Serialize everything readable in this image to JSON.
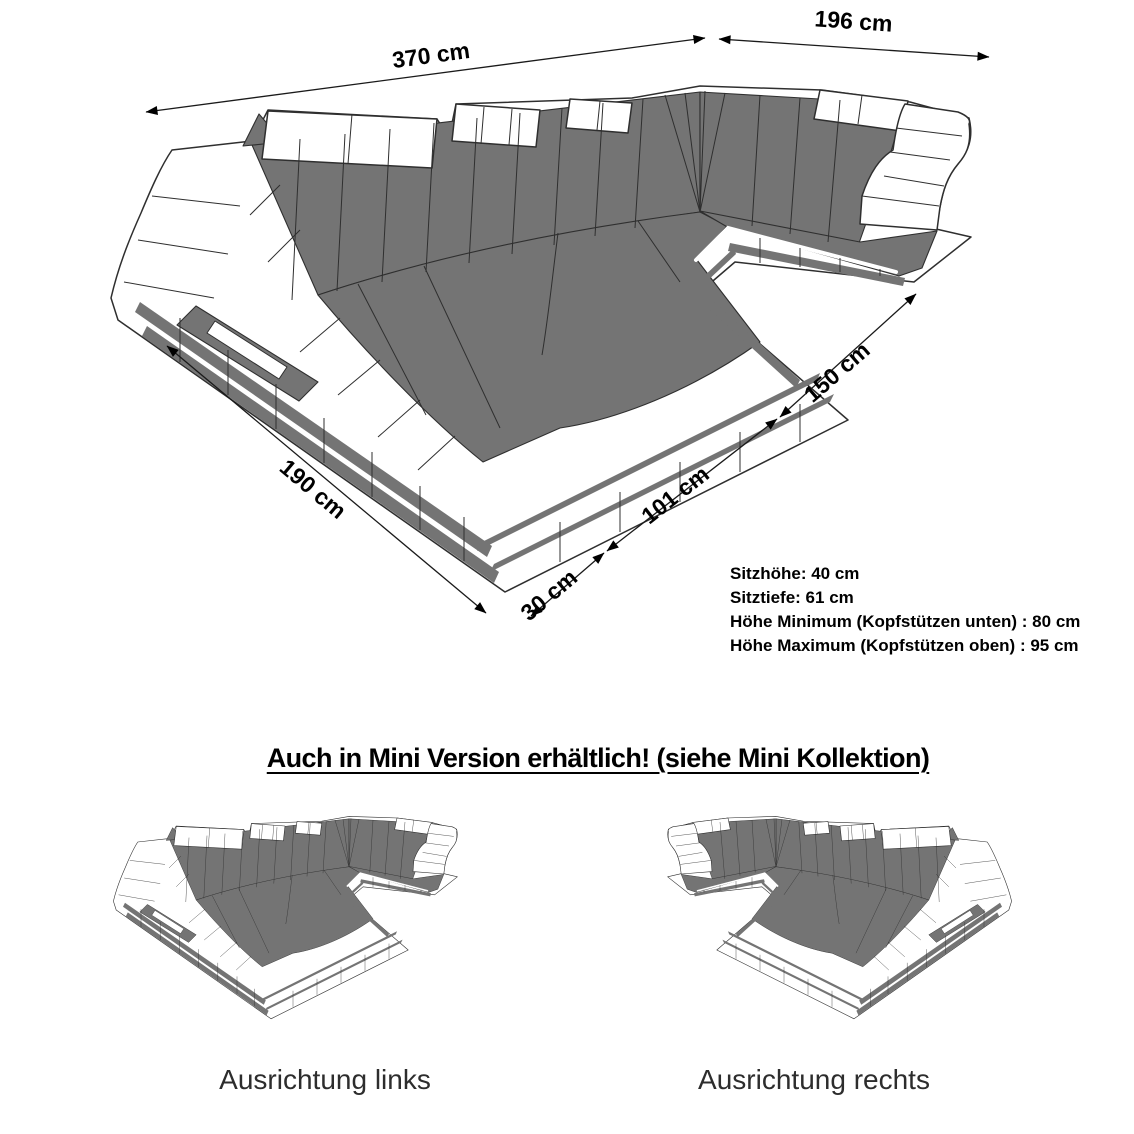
{
  "diagram": {
    "dimensions": {
      "total_width": "370 cm",
      "right_depth": "196 cm",
      "right_inner_depth": "150 cm",
      "inner_width": "101 cm",
      "front_edge": "30 cm",
      "left_depth": "190 cm"
    },
    "specs": [
      "Sitzhöhe: 40 cm",
      "Sitztiefe: 61 cm",
      "Höhe Minimum (Kopfstützen unten) : 80 cm",
      "Höhe Maximum (Kopfstützen oben) : 95 cm"
    ],
    "mini_section": {
      "heading": "Auch in Mini Version erhältlich! (siehe Mini Kollektion)",
      "left_label": "Ausrichtung links",
      "right_label": "Ausrichtung rechts"
    },
    "colors": {
      "upholstery": "#747474",
      "outline": "#2f2f2f",
      "background": "#ffffff",
      "text": "#000000"
    }
  }
}
